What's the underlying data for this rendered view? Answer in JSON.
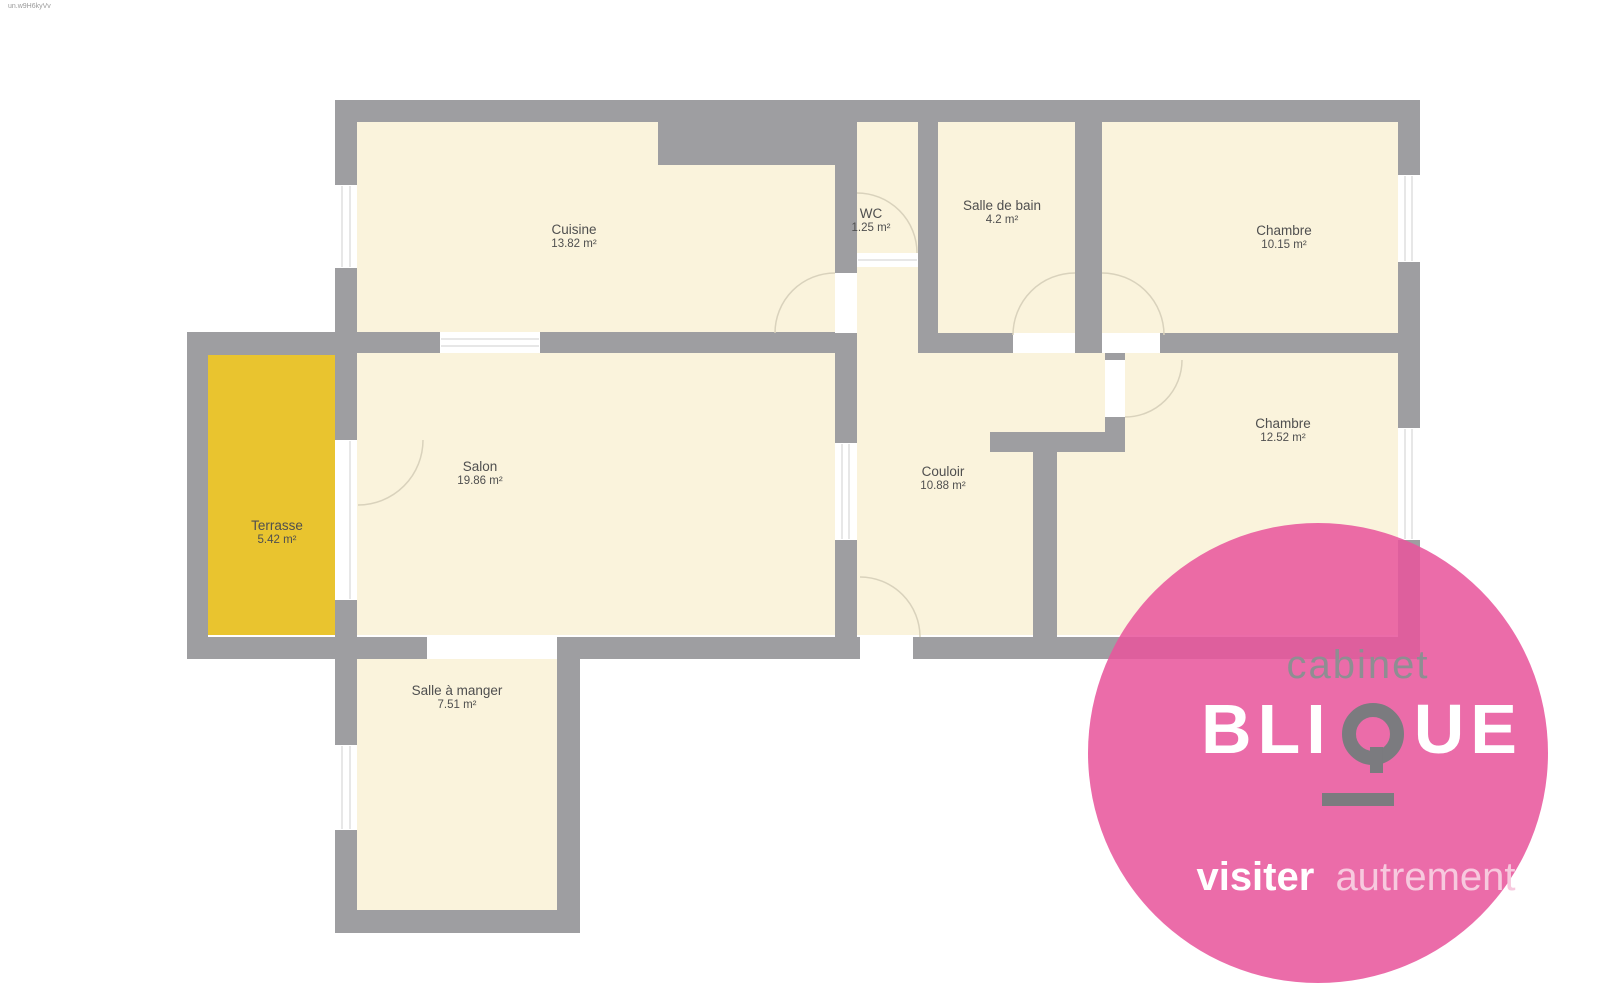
{
  "watermark": "un.w9H6kyVv",
  "rooms": [
    {
      "id": "cuisine",
      "name": "Cuisine",
      "area": "13.82 m²"
    },
    {
      "id": "wc",
      "name": "WC",
      "area": "1.25 m²"
    },
    {
      "id": "salle-de-bain",
      "name": "Salle de bain",
      "area": "4.2 m²"
    },
    {
      "id": "chambre-1",
      "name": "Chambre",
      "area": "10.15 m²"
    },
    {
      "id": "salon",
      "name": "Salon",
      "area": "19.86 m²"
    },
    {
      "id": "couloir",
      "name": "Couloir",
      "area": "10.88 m²"
    },
    {
      "id": "chambre-2",
      "name": "Chambre",
      "area": "12.52 m²"
    },
    {
      "id": "terrasse",
      "name": "Terrasse",
      "area": "5.42 m²"
    },
    {
      "id": "salle-a-manger",
      "name": "Salle à manger",
      "area": "7.51 m²"
    }
  ],
  "logo": {
    "brand_top": "cabinet",
    "wordmark_left": "BLI",
    "wordmark_right": "UE",
    "tagline_bold": "visiter",
    "tagline_light": "autrement"
  },
  "colors": {
    "wall_gray": "#9e9ea1",
    "room_fill": "#faf3dc",
    "terrace_fill": "#e9c42f",
    "brand_pink": "#e8569c",
    "logo_gray": "#7b7b7f"
  }
}
